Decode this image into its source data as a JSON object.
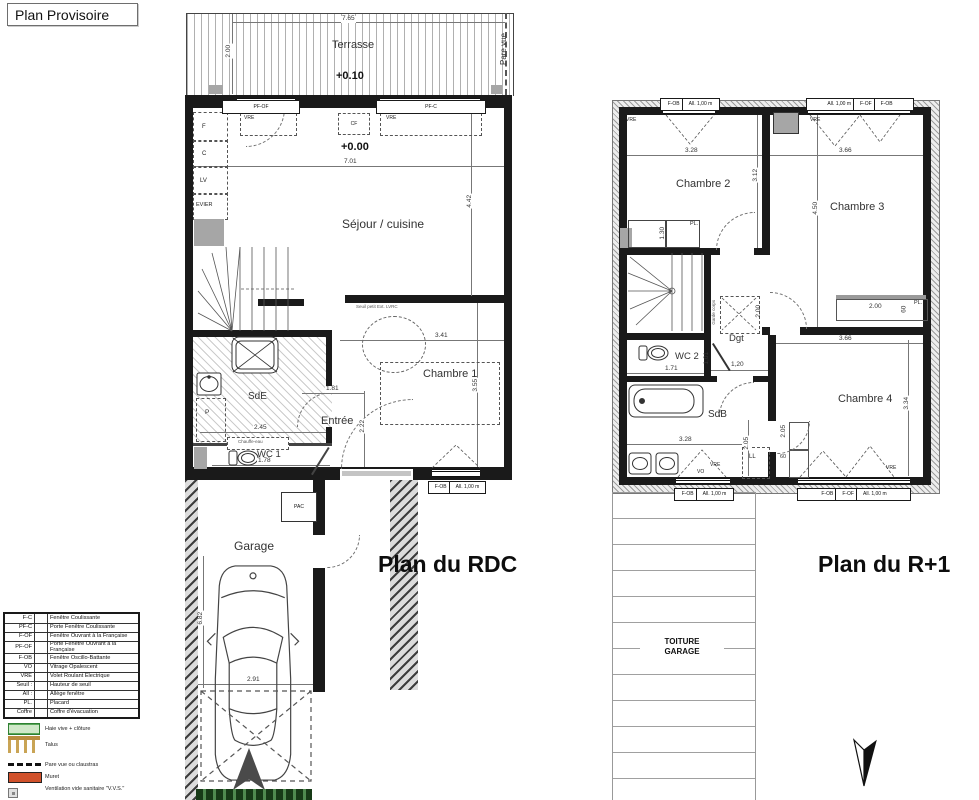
{
  "header": {
    "title": "Plan Provisoire"
  },
  "rdc": {
    "title": "Plan du RDC",
    "terrasse": {
      "label": "Terrasse",
      "level": "+0.10",
      "w": "7.65",
      "h": "2.00"
    },
    "pare_vue": "Pare vue",
    "openings": {
      "left": "PF-OF",
      "right": "PF-C",
      "cf": "CF",
      "vre": "VRE"
    },
    "sejour": {
      "label": "Séjour / cuisine",
      "level": "+0.00",
      "w": "7.01",
      "h": "4.42"
    },
    "kitchen": {
      "f": "F",
      "c": "C",
      "lv": "LV",
      "evier": "EVIER"
    },
    "sde": {
      "label": "SdE",
      "w": "2.45",
      "p": "P",
      "note": "Chauffe-eau"
    },
    "wc1": {
      "label": "WC 1",
      "w": "1.78"
    },
    "entree": {
      "label": "Entrée",
      "w": "1.81",
      "h": "2.22"
    },
    "ch1": {
      "label": "Chambre 1",
      "w": "3.41",
      "h": "3.55",
      "note": "Seuil petit Ext. LVRC"
    },
    "window": {
      "type": "F-OB",
      "allege": "All. 1,00 m"
    },
    "garage": {
      "label": "Garage",
      "pac": "PAC",
      "w": "2.91",
      "h": "6.82"
    }
  },
  "r1": {
    "title": "Plan du R+1",
    "ch2": {
      "label": "Chambre 2",
      "w": "3.28",
      "h": "3.12"
    },
    "ch3": {
      "label": "Chambre 3",
      "w": "3.66",
      "h": "4.50"
    },
    "ch4": {
      "label": "Chambre 4",
      "w": "3.66",
      "h": "3.34"
    },
    "wc2": {
      "label": "WC 2",
      "w": "1.71",
      "door": "1,01"
    },
    "dgt": {
      "label": "Dgt",
      "w": "1,20"
    },
    "sdb": {
      "label": "SdB",
      "w": "3.28",
      "h": "2.05"
    },
    "pl": "PL.",
    "ll": "LL",
    "sep": "60",
    "placards": {
      "ch2_dim": "1.30",
      "ch3_w": "2.00",
      "ch3_d": "60",
      "ch4_d": "2.05"
    },
    "tremie": {
      "note": "Garde corps",
      "h": "2.00"
    },
    "vre": "VRE",
    "vo": "VO",
    "openings": {
      "tl1": "F-OB",
      "tl2": "All. 1,00 m",
      "tr1": "All. 1,00 m",
      "tr2": "F-OF",
      "tr3": "F-OB",
      "bl1": "F-OB",
      "bl2": "All. 1,00 m",
      "br1": "F-OB",
      "br2": "F-OF",
      "br3": "All. 1,00 m"
    },
    "toiture": {
      "l1": "TOITURE",
      "l2": "GARAGE"
    }
  },
  "legend": {
    "rows": [
      {
        "code": "F-C",
        "label": "Fenêtre Coulissante"
      },
      {
        "code": "PF-C",
        "label": "Porte Fenêtre Coulissante"
      },
      {
        "code": "F-OF",
        "label": "Fenêtre Ouvrant à la Française"
      },
      {
        "code": "PF-OF",
        "label": "Porte Fenêtre Ouvrant à la Française"
      },
      {
        "code": "F-OB",
        "label": "Fenêtre Oscillo-Battante"
      },
      {
        "code": "VO",
        "label": "Vitrage Opalescent"
      },
      {
        "code": "VRE",
        "label": "Volet Roulant Electrique"
      },
      {
        "code": "Seuil :",
        "label": "Hauteur de seuil"
      },
      {
        "code": "All :",
        "label": "Allège fenêtre"
      },
      {
        "code": "PL.",
        "label": "Placard"
      },
      {
        "code": "Coffre",
        "label": "Coffre d'évacuation"
      }
    ],
    "symbols": [
      {
        "label": "Haie vive + clôture"
      },
      {
        "label": "Talus"
      },
      {
        "label": "Pare vue ou claustras"
      },
      {
        "label": "Muret"
      },
      {
        "label": "Ventilation vide sanitaire \"V.V.S.\""
      }
    ],
    "colors": {
      "haie": "#cfe8c8",
      "haie_border": "#2f8032",
      "talus": "#c9a455",
      "muret": "#d0512b"
    }
  }
}
